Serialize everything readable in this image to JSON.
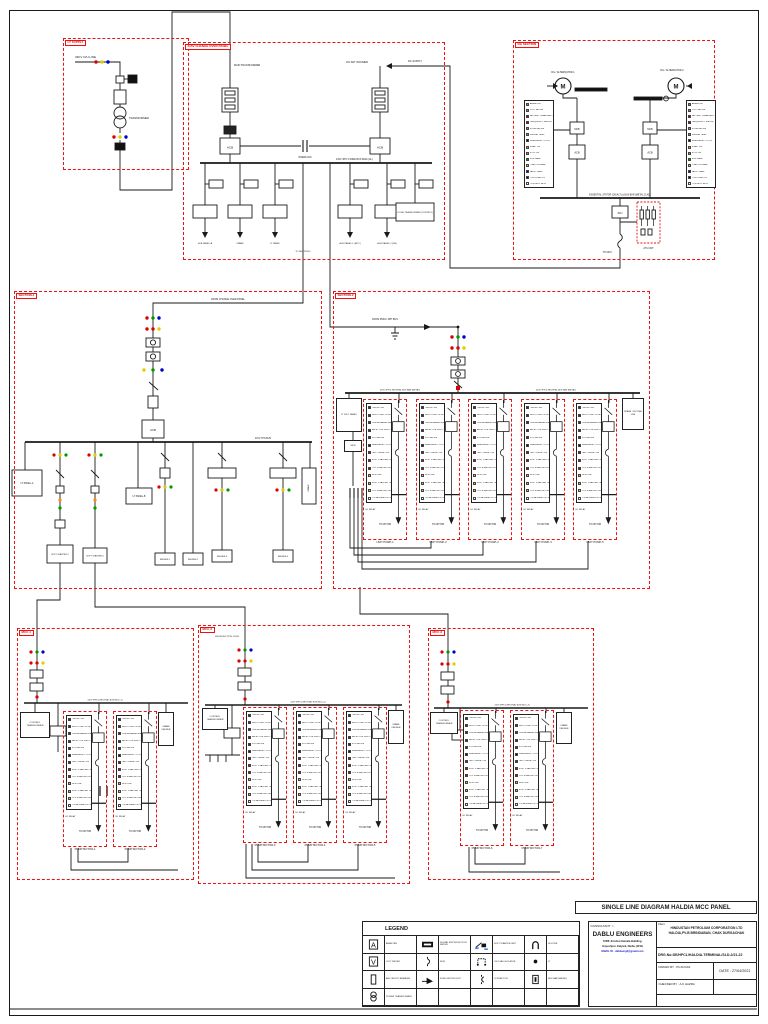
{
  "page": {
    "title": "SINGLE LINE DIAGRAM HALDIA MCC PANEL"
  },
  "title_block": {
    "consultant_label": "CONSULTANT :>",
    "consultant_name": "DABLU ENGINEERS",
    "consultant_addr1": "72/88 ,Krishna Kamala Building,",
    "consultant_addr2": "Gayeshpur, Kalyani, Nadia, (W.B)",
    "consultant_email": "EMAIL ID - dablueng3@gmail.com",
    "client_label": "Client",
    "client_line1": "HINDUSTAN PETROLIUM  CORPORATION LTD",
    "client_line2": "HALDIA,PV-B BRINDABAN, CHAK DURGACHAK",
    "drg_no": "DRG.No:DE/HPCL/HALDIA-TERMINAL/SLD-2/21-22",
    "drawn_by": "DRAWN BY :  PUJA DAS",
    "date": "DATE : 27/04/2021",
    "checked_by": "CHECKED BY :   A.K HAZRA"
  },
  "legend": {
    "title": "LEGEND",
    "rows": [
      [
        {
          "icon": "ammeter",
          "label": "AMMETER"
        },
        {
          "icon": "digital-meter",
          "label": "DIGITAL MULTIFUNCTION METER"
        },
        {
          "icon": "soft-starter",
          "label": "SOFT STARTER UNIT"
        },
        {
          "icon": "hooter",
          "label": "HOOTER"
        }
      ],
      [
        {
          "icon": "voltmeter",
          "label": "VOLT METER"
        },
        {
          "icon": "mcb",
          "label": "MCB"
        },
        {
          "icon": "isolator",
          "label": "ON LOAD ISOLATOR"
        },
        {
          "icon": "indicator-lamp",
          "label": "LT"
        }
      ],
      [
        {
          "icon": "acb",
          "label": "AIR CIRCUIT BREAKER"
        },
        {
          "icon": "switch-fuse",
          "label": "FUSE SWITCH UNIT"
        },
        {
          "icon": "contactor",
          "label": "CONTACTOR"
        },
        {
          "icon": "busbar",
          "label": "BUS BAR (METAL)"
        }
      ],
      [
        {
          "icon": "transformer",
          "label": "POWER TRANSFORMER"
        },
        null,
        null,
        null
      ]
    ]
  },
  "module_rows": [
    {
      "c": "#333",
      "t": "ON/OFF SW"
    },
    {
      "c": "#333",
      "t": "MULTI FUNCTION METER"
    },
    {
      "c": "#333",
      "t": "DIGITAL AMMETER"
    },
    {
      "c": "#333",
      "t": "SELECTOR SWITCH"
    },
    {
      "c": "#333",
      "t": "RTD METER"
    },
    {
      "c": "#111",
      "t": "EMERGENCY STOP"
    },
    {
      "c": "#c00",
      "t": "TRIP / RESET PB"
    },
    {
      "c": "#c00",
      "t": "SOFT STARTER ON"
    },
    {
      "c": "#c00",
      "t": "DOL STARTER ON"
    },
    {
      "c": "#dfcf00",
      "t": "MCB TRIP"
    },
    {
      "c": "#dfcf00",
      "t": "SOFT STARTER TRIP"
    },
    {
      "c": "#dfcf00",
      "t": "DOL STARTER OFF"
    },
    {
      "c": "#fff",
      "t": "LOCAL/REMOTE SW"
    }
  ],
  "module_bits": {
    "overload": "O/L RELAY",
    "to_motor": "TO MOTOR",
    "starter": "SOFT STARTER"
  },
  "dg_rows": [
    {
      "c": "#888",
      "t": "AMMETER"
    },
    {
      "c": "#888",
      "t": "VOLT METER"
    },
    {
      "c": "#801010",
      "t": "BATTERY CHARGER ON"
    },
    {
      "c": "#a00",
      "t": "FREQUENCY METER"
    },
    {
      "c": "#888",
      "t": "HOUR METER"
    },
    {
      "c": "#888",
      "t": "ENGINE TEMP"
    },
    {
      "c": "#111",
      "t": "EMERGENCY STOP"
    },
    {
      "c": "#f80",
      "t": "START PB"
    },
    {
      "c": "#e6a",
      "t": "STOP PB"
    },
    {
      "c": "#090",
      "t": "RUN LAMP"
    },
    {
      "c": "#dfcf00",
      "t": "LOAD ON LAMP"
    },
    {
      "c": "#00c",
      "t": "FAULT LAMP"
    },
    {
      "c": "#111",
      "t": "LOW LUBE OIL"
    },
    {
      "c": "#fff",
      "t": "CONTROL MCB"
    }
  ],
  "sections": {
    "lt_supply": {
      "tag": "LT SUPPLY",
      "line": "33KV O/H LINE",
      "transformer": "TRANSFORMER"
    },
    "change_over": {
      "tag": "415V CHANGE OVER PANEL",
      "left_feeder": "MAIN TRANSFORMER",
      "right_feeder": "DG SET INCOMER",
      "dg_supply": "DG SUPPLY",
      "acb": "ACB",
      "interlock": "INTERLOCK",
      "bus": "415V 3PH 4 WIRE BUS 800A (AL)",
      "to_section": "TO SECTION-1",
      "feeders": [
        "SUB PANEL-A",
        "SPARE",
        "LT PANEL",
        "AUX PANEL-1 (MCC)",
        "AUX PANEL-2 (DB)"
      ],
      "wide_feeder": "LOCAL TRANSFORMER (CONTROL)"
    },
    "dg": {
      "tag": "DG SECTION",
      "m": "M",
      "alt1": "DG / ALTERNATOR-1",
      "alt2": "DG / ALTERNATOR-2",
      "mcb": "MCB",
      "acb": "ACB",
      "bus": "ESSENTIAL STATOR (DG/ALT) & BUS BAR (METAL CLAD)",
      "sfu": "SFU",
      "ats": "ATS UNIT",
      "out": "TO MCC"
    },
    "section1": {
      "tag": "SECTION-1",
      "incomer": "FROM CHANGE OVER PANEL",
      "acb": "ACB",
      "bus": "415V TPN BUS",
      "boxA": "LT PANEL-A",
      "boxD": "LT PANEL-B",
      "spare": "SPARE",
      "feeders": [
        "SOFT STARTER-1",
        "SOFT STARTER-2",
        "FEEDER-1",
        "FEEDER-2",
        "FEEDER-3",
        "FEEDER-4"
      ]
    },
    "section2": {
      "tag": "SECTION-2",
      "incomer": "FROM PMCC 3PH BUS",
      "bus_l": "415V 3PH & NEUTRAL BUS BAR (METAL)",
      "bus_r": "415V 3PH & NEUTRAL BUS BAR (METAL)",
      "left_cap": "LT DIST. PANEL",
      "left_sub": "MCB",
      "right_cap": "SPARE / FUTURE USE",
      "modules": [
        "UNIT PUMP-1",
        "UNIT PUMP-2",
        "UNIT PUMP-3",
        "UNIT PUMP-4",
        "UNIT PUMP-5"
      ]
    },
    "mcc1": {
      "tag": "MCC-1",
      "bus": "415V 3PH & NEUTRAL BUS (MCC-1)",
      "ctrl": "CONTROL TRANSFORMER",
      "right_cap": "SPARE FEEDER",
      "modules": [
        "PUMP MOTOR-1",
        "PUMP MOTOR-2"
      ]
    },
    "mcc2": {
      "tag": "MCC-2",
      "incomer": "FROM SECTION-1 BUS",
      "bus": "415V 3PH & NEUTRAL BUS (MCC-2)",
      "ctrl": "CONTROL TRANSFORMER",
      "right_cap": "SPARE FEEDER",
      "modules": [
        "PUMP MOTOR-3",
        "PUMP MOTOR-4",
        "PUMP MOTOR-5"
      ]
    },
    "mcc3": {
      "tag": "MCC-3",
      "bus": "415V 3PH & NEUTRAL BUS (MCC-3)",
      "ctrl": "CONTROL TRANSFORMER",
      "right_cap": "SPARE FEEDER",
      "modules": [
        "PUMP MOTOR-6",
        "PUMP MOTOR-7"
      ]
    }
  }
}
